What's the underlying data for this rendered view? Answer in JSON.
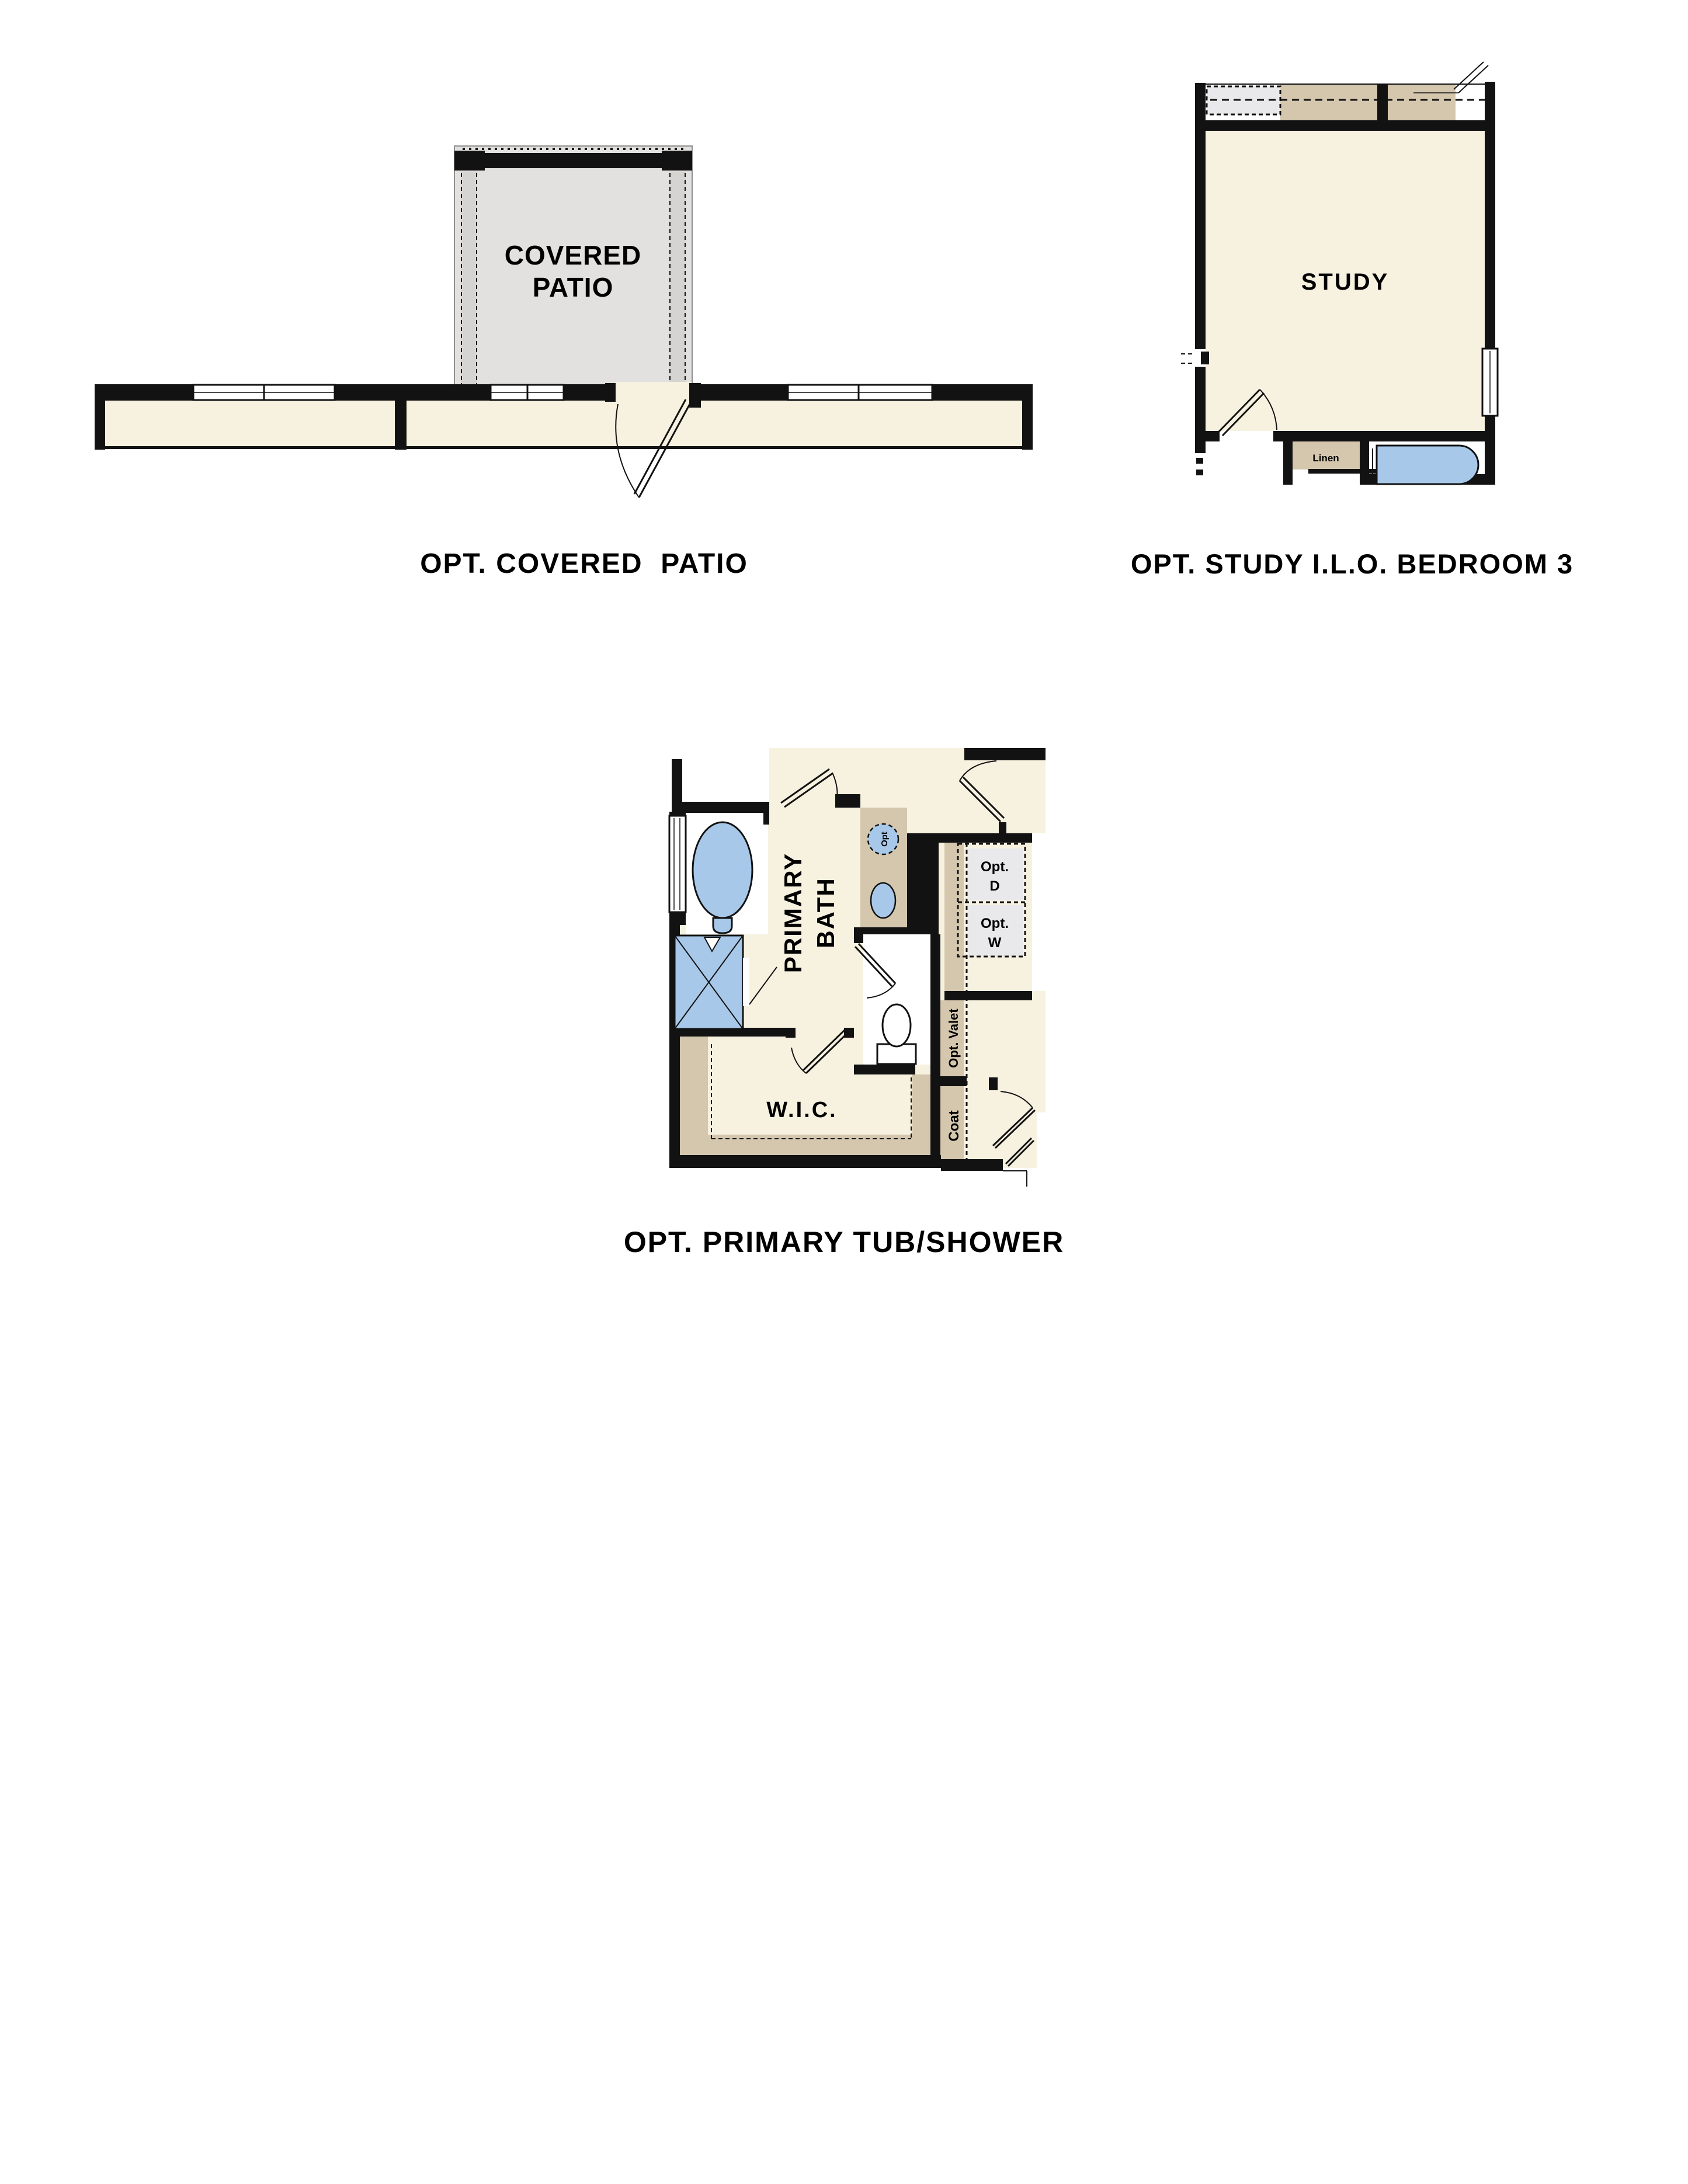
{
  "document": {
    "type": "floor-plan-options-sheet",
    "background": "#ffffff"
  },
  "colors": {
    "wall": "#121212",
    "cream": "#f7f1e0",
    "tan": "#d4c7ae",
    "patio_gray": "#e3e1df",
    "pillar_gray": "#d6d4d1",
    "box_gray": "#e9e9eb",
    "fixture_blue": "#a7c8e9"
  },
  "captions": {
    "patio": "OPT. COVERED  PATIO",
    "study": "OPT. STUDY I.L.O. BEDROOM 3",
    "bath": "OPT. PRIMARY TUB/SHOWER"
  },
  "plans": {
    "patio": {
      "name_line1": "COVERED",
      "name_line2": "PATIO"
    },
    "study": {
      "name": "STUDY",
      "linen": "Linen"
    },
    "bath": {
      "name_line1": "PRIMARY",
      "name_line2": "BATH",
      "wic": "W.I.C.",
      "opt_d_line1": "Opt.",
      "opt_d_line2": "D",
      "opt_w_line1": "Opt.",
      "opt_w_line2": "W",
      "opt_valet": "Opt. Valet",
      "coat": "Coat",
      "opt_sink": "Opt"
    }
  }
}
